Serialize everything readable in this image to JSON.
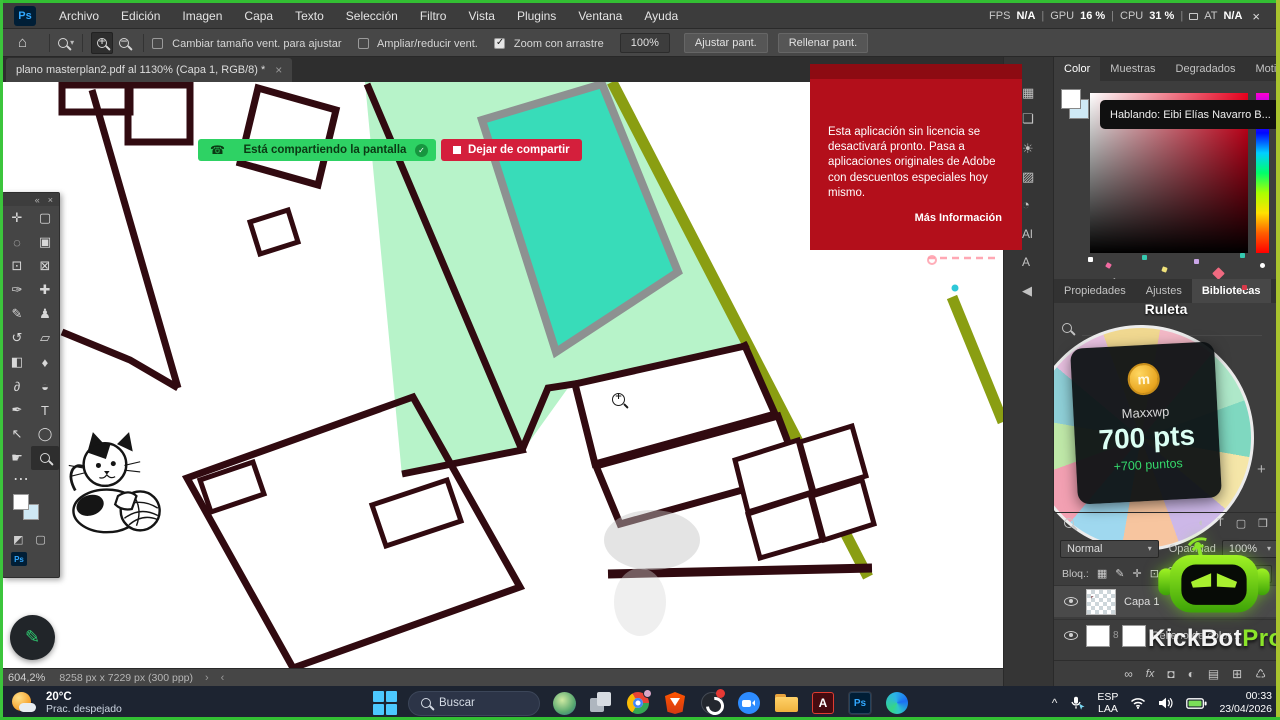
{
  "colors": {
    "share_green": "#2ed264",
    "stop_red": "#d41f3c",
    "banner_red": "#b30f1b",
    "road_olive": "#8a9e12",
    "pool_teal": "#38dcb9",
    "lawn_mint": "#b7f3c9",
    "plot_line": "#310a10",
    "taskbar_navy": "#1d2431",
    "ps_accent_blue": "#31a8ff",
    "kickbot_green": "#8be42a",
    "points_green": "#35d96b",
    "border_green": "#33bf33"
  },
  "menu": {
    "logo": "Ps",
    "items": [
      "Archivo",
      "Edición",
      "Imagen",
      "Capa",
      "Texto",
      "Selección",
      "Filtro",
      "Vista",
      "Plugins",
      "Ventana",
      "Ayuda"
    ]
  },
  "perf": {
    "fps_label": "FPS",
    "fps_value": "N/A",
    "gpu_label": "GPU",
    "gpu_value": "16 %",
    "cpu_label": "CPU",
    "cpu_value": "31 %",
    "lat_label": "AT",
    "lat_value": "N/A",
    "close": "×",
    "sep": "|"
  },
  "options": {
    "home_icon": "⌂",
    "checkbox1": {
      "label": "Cambiar tamaño vent. para ajustar",
      "checked": false
    },
    "checkbox2": {
      "label": "Ampliar/reducir vent.",
      "checked": false
    },
    "checkbox3": {
      "label": "Zoom con arrastre",
      "checked": true
    },
    "zoom_value": "100%",
    "fit_button": "Ajustar pant.",
    "fill_button": "Rellenar pant."
  },
  "doc_tab": {
    "title": "plano masterplan2.pdf al 1130% (Capa 1, RGB/8) *",
    "close": "×"
  },
  "toolbar": {
    "collapse": "«",
    "close": "×",
    "more": "⋯",
    "tools": [
      {
        "name": "move-tool",
        "glyph": "✛"
      },
      {
        "name": "marquee-tool",
        "glyph": "▢"
      },
      {
        "name": "lasso-tool",
        "glyph": "◌"
      },
      {
        "name": "object-selection-tool",
        "glyph": "▣"
      },
      {
        "name": "crop-tool",
        "glyph": "⊡"
      },
      {
        "name": "frame-tool",
        "glyph": "⊠"
      },
      {
        "name": "eyedropper-tool",
        "glyph": "✑"
      },
      {
        "name": "healing-brush-tool",
        "glyph": "✚"
      },
      {
        "name": "brush-tool",
        "glyph": "✎"
      },
      {
        "name": "clone-stamp-tool",
        "glyph": "♟"
      },
      {
        "name": "history-brush-tool",
        "glyph": "↺"
      },
      {
        "name": "eraser-tool",
        "glyph": "▱"
      },
      {
        "name": "gradient-tool",
        "glyph": "◧"
      },
      {
        "name": "blur-tool",
        "glyph": "♦"
      },
      {
        "name": "smudge-tool",
        "glyph": "∂"
      },
      {
        "name": "dodge-tool",
        "glyph": "◒"
      },
      {
        "name": "pen-tool",
        "glyph": "✒"
      },
      {
        "name": "type-tool",
        "glyph": "T"
      },
      {
        "name": "path-selection-tool",
        "glyph": "↖"
      },
      {
        "name": "ellipse-tool",
        "glyph": "◯"
      },
      {
        "name": "hand-tool",
        "glyph": "☛"
      }
    ],
    "ps_badge": "Ps"
  },
  "share": {
    "phone_icon": "☎",
    "text": "Está compartiendo la pantalla",
    "check": "✓",
    "stop": "Dejar de compartir"
  },
  "banner": {
    "message": "Esta aplicación sin licencia se desactivará pronto. Pasa a aplicaciones originales de Adobe con descuentos especiales hoy mismo.",
    "link": "Más Información"
  },
  "speaking": {
    "text": "Hablando: Eibi Elías Navarro B..."
  },
  "dock_icons": [
    {
      "name": "panel-history-icon",
      "glyph": "▦"
    },
    {
      "name": "panel-comments-icon",
      "glyph": "❏"
    },
    {
      "name": "panel-adjustments-icon",
      "glyph": "☀"
    },
    {
      "name": "panel-gradients-icon",
      "glyph": "▨"
    },
    {
      "name": "panel-curves-icon",
      "glyph": "◔"
    },
    {
      "name": "panel-ai-icon",
      "glyph": "Al"
    },
    {
      "name": "panel-character-icon",
      "glyph": "A"
    },
    {
      "name": "panel-audio-icon",
      "glyph": "◀"
    }
  ],
  "color_panel": {
    "tabs": [
      {
        "label": "Color"
      },
      {
        "label": "Muestras"
      },
      {
        "label": "Degradados"
      },
      {
        "label": "Motivos"
      }
    ]
  },
  "props_tabs": [
    {
      "label": "Propiedades"
    },
    {
      "label": "Ajustes"
    },
    {
      "label": "Bibliotecas"
    }
  ],
  "ruleta": {
    "title": "Ruleta",
    "coin": "m",
    "winner": "Maxxwp",
    "points": "700 pts",
    "bonus": "+700 puntos",
    "add": "+"
  },
  "layers": {
    "filter_icons": [
      "◐",
      "T",
      "▢",
      "❒"
    ],
    "blend_mode": "Normal",
    "opacity_label": "Opacidad",
    "opacity_value": "100%",
    "lock_label": "Bloq.:",
    "fill_value": "100%",
    "row1_name": "Capa 1",
    "row2_name": "Relleno de color 1",
    "chain": "8",
    "bottom_icons": [
      {
        "name": "link-layers-icon",
        "glyph": "∞"
      },
      {
        "name": "layer-effects-icon",
        "glyph": "fx"
      },
      {
        "name": "layer-mask-icon",
        "glyph": "◘"
      },
      {
        "name": "adjustment-layer-icon",
        "glyph": "◐"
      },
      {
        "name": "layer-group-icon",
        "glyph": "▤"
      },
      {
        "name": "new-layer-icon",
        "glyph": "⊞"
      },
      {
        "name": "delete-layer-icon",
        "glyph": "♺"
      }
    ]
  },
  "kickbot": {
    "brand": "KickBot",
    "suffix": "Pro"
  },
  "statusbar": {
    "zoom": "604,2%",
    "doc_info": "8258 px x 7229 px (300 ppp)",
    "arrow_r": "›",
    "arrow_l": "‹"
  },
  "taskbar": {
    "weather": {
      "temp": "20°C",
      "condition": "Prac. despejado"
    },
    "search_label": "Buscar",
    "apps": [
      {
        "name": "nature-app"
      },
      {
        "name": "task-view"
      },
      {
        "name": "chrome"
      },
      {
        "name": "brave"
      },
      {
        "name": "obs"
      },
      {
        "name": "zoom-app"
      },
      {
        "name": "file-explorer"
      },
      {
        "name": "acrobat",
        "label": "A"
      },
      {
        "name": "photoshop",
        "label": "Ps",
        "active": true
      },
      {
        "name": "edge"
      }
    ],
    "tray": {
      "chevron": "^",
      "lang_top": "ESP",
      "lang_bottom": "LAA",
      "time": "00:33",
      "date": "23/04/2026"
    }
  }
}
